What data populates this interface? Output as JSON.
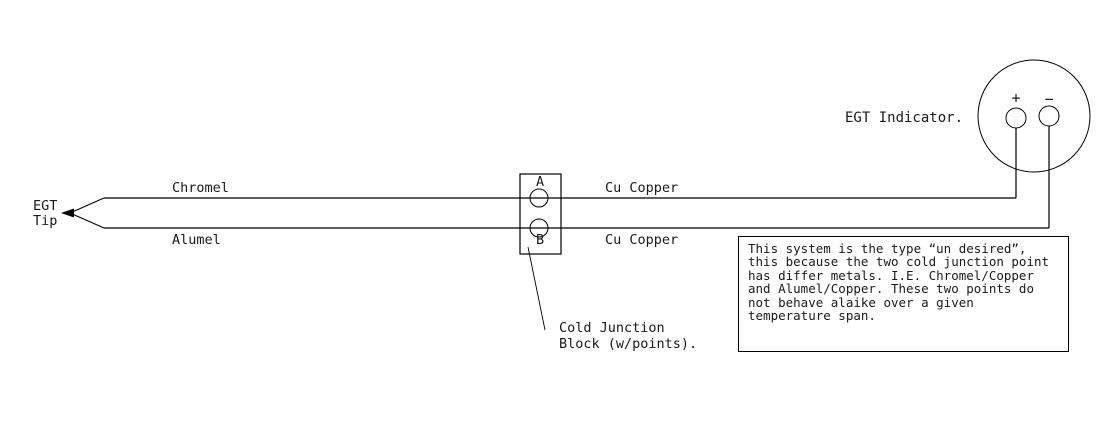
{
  "labels": {
    "egt_tip": [
      "EGT",
      "Tip"
    ],
    "chromel": "Chromel",
    "alumel": "Alumel",
    "cu_copper_top": "Cu Copper",
    "cu_copper_bottom": "Cu Copper",
    "terminal_a": "A",
    "terminal_b": "B",
    "block_caption": [
      "Cold Junction",
      "Block (w/points)."
    ],
    "indicator": "EGT Indicator.",
    "plus": "+",
    "minus": "−"
  },
  "note": {
    "lines": [
      "This system is the type “un desired”,",
      "this because the two cold junction point",
      "has differ metals. I.E. Chromel/Copper",
      "and Alumel/Copper. These two points do",
      "not behave alaike over a given",
      "temperature span."
    ]
  },
  "colors": {
    "line": "#000000",
    "background": "#ffffff"
  }
}
